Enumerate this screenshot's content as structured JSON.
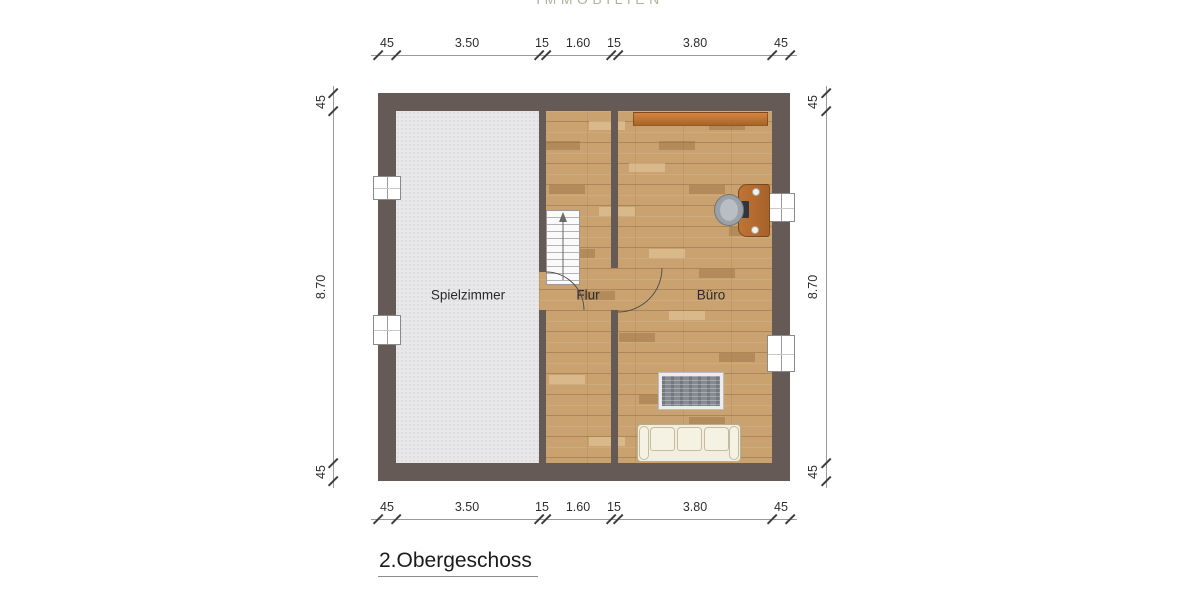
{
  "logo": {
    "text": "IMMOBILIEN"
  },
  "floor_title": "2.Obergeschoss",
  "rooms": [
    {
      "name": "Spielzimmer"
    },
    {
      "name": "Flur"
    },
    {
      "name": "Büro"
    }
  ],
  "dimensions": {
    "horizontal_top": [
      "45",
      "3.50",
      "15",
      "1.60",
      "15",
      "3.80",
      "45"
    ],
    "horizontal_bottom": [
      "45",
      "3.50",
      "15",
      "1.60",
      "15",
      "3.80",
      "45"
    ],
    "vertical_left": [
      "45",
      "8.70",
      "45"
    ],
    "vertical_right": [
      "45",
      "8.70",
      "45"
    ]
  },
  "furniture": [
    "staircase",
    "sideboard",
    "desk",
    "office-chair",
    "laptop",
    "rug",
    "sofa"
  ],
  "colors": {
    "wall": "#665a56",
    "wood_floor": "#c9a26f",
    "carpet": "#e8e8ea",
    "sideboard_orange": "#c97a36",
    "desk_orange": "#b5722f",
    "rug_gray": "#848b93",
    "sofa_cream": "#f3eedd",
    "logo_khaki": "#b3b19b"
  }
}
